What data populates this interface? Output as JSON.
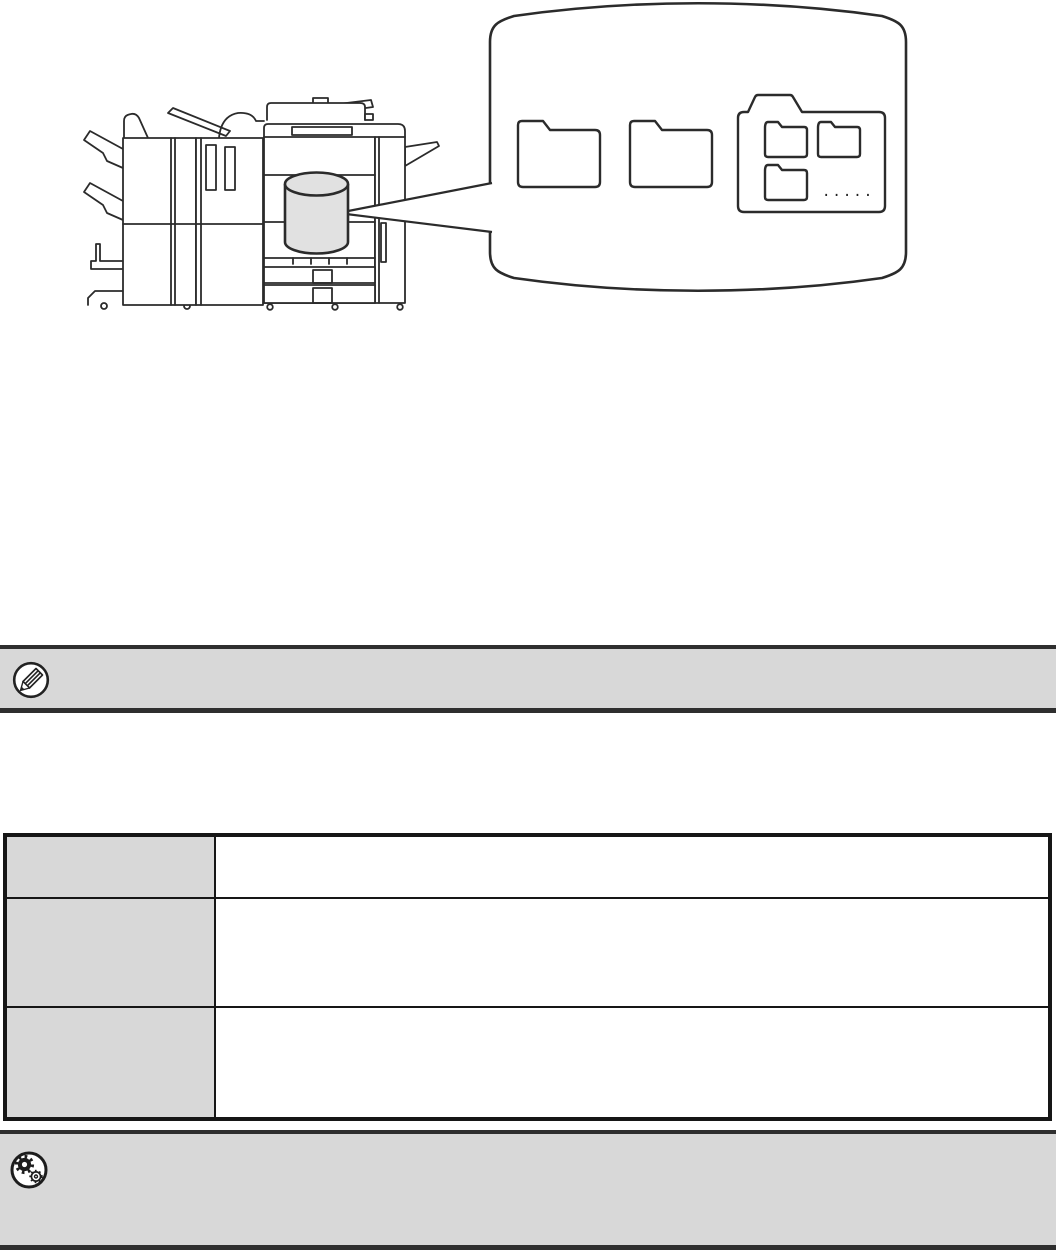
{
  "page_type": "printer-manual-illustration-page",
  "colors": {
    "page_background": "#ffffff",
    "bar_background": "#d8d8d8",
    "bar_border": "#2f2f2f",
    "table_border": "#161616",
    "table_header_background": "#d8d8d8",
    "line_art": "#2b2b2b",
    "hard_drive_fill": "#e1e1e1"
  },
  "illustration": {
    "subject": "multifunction-printer-with-hard-drive",
    "balloon_shape": "drum-cylinder",
    "plain_folders": 2,
    "folder_group_children": 3,
    "balloon_dots": "....."
  },
  "note_section": {
    "icon": "note-pencil-icon",
    "text": ""
  },
  "table": {
    "rows": [
      {
        "label": "",
        "content": ""
      },
      {
        "label": "",
        "content": ""
      },
      {
        "label": "",
        "content": ""
      }
    ]
  },
  "settings_section": {
    "icon": "settings-gears-icon",
    "text": ""
  }
}
